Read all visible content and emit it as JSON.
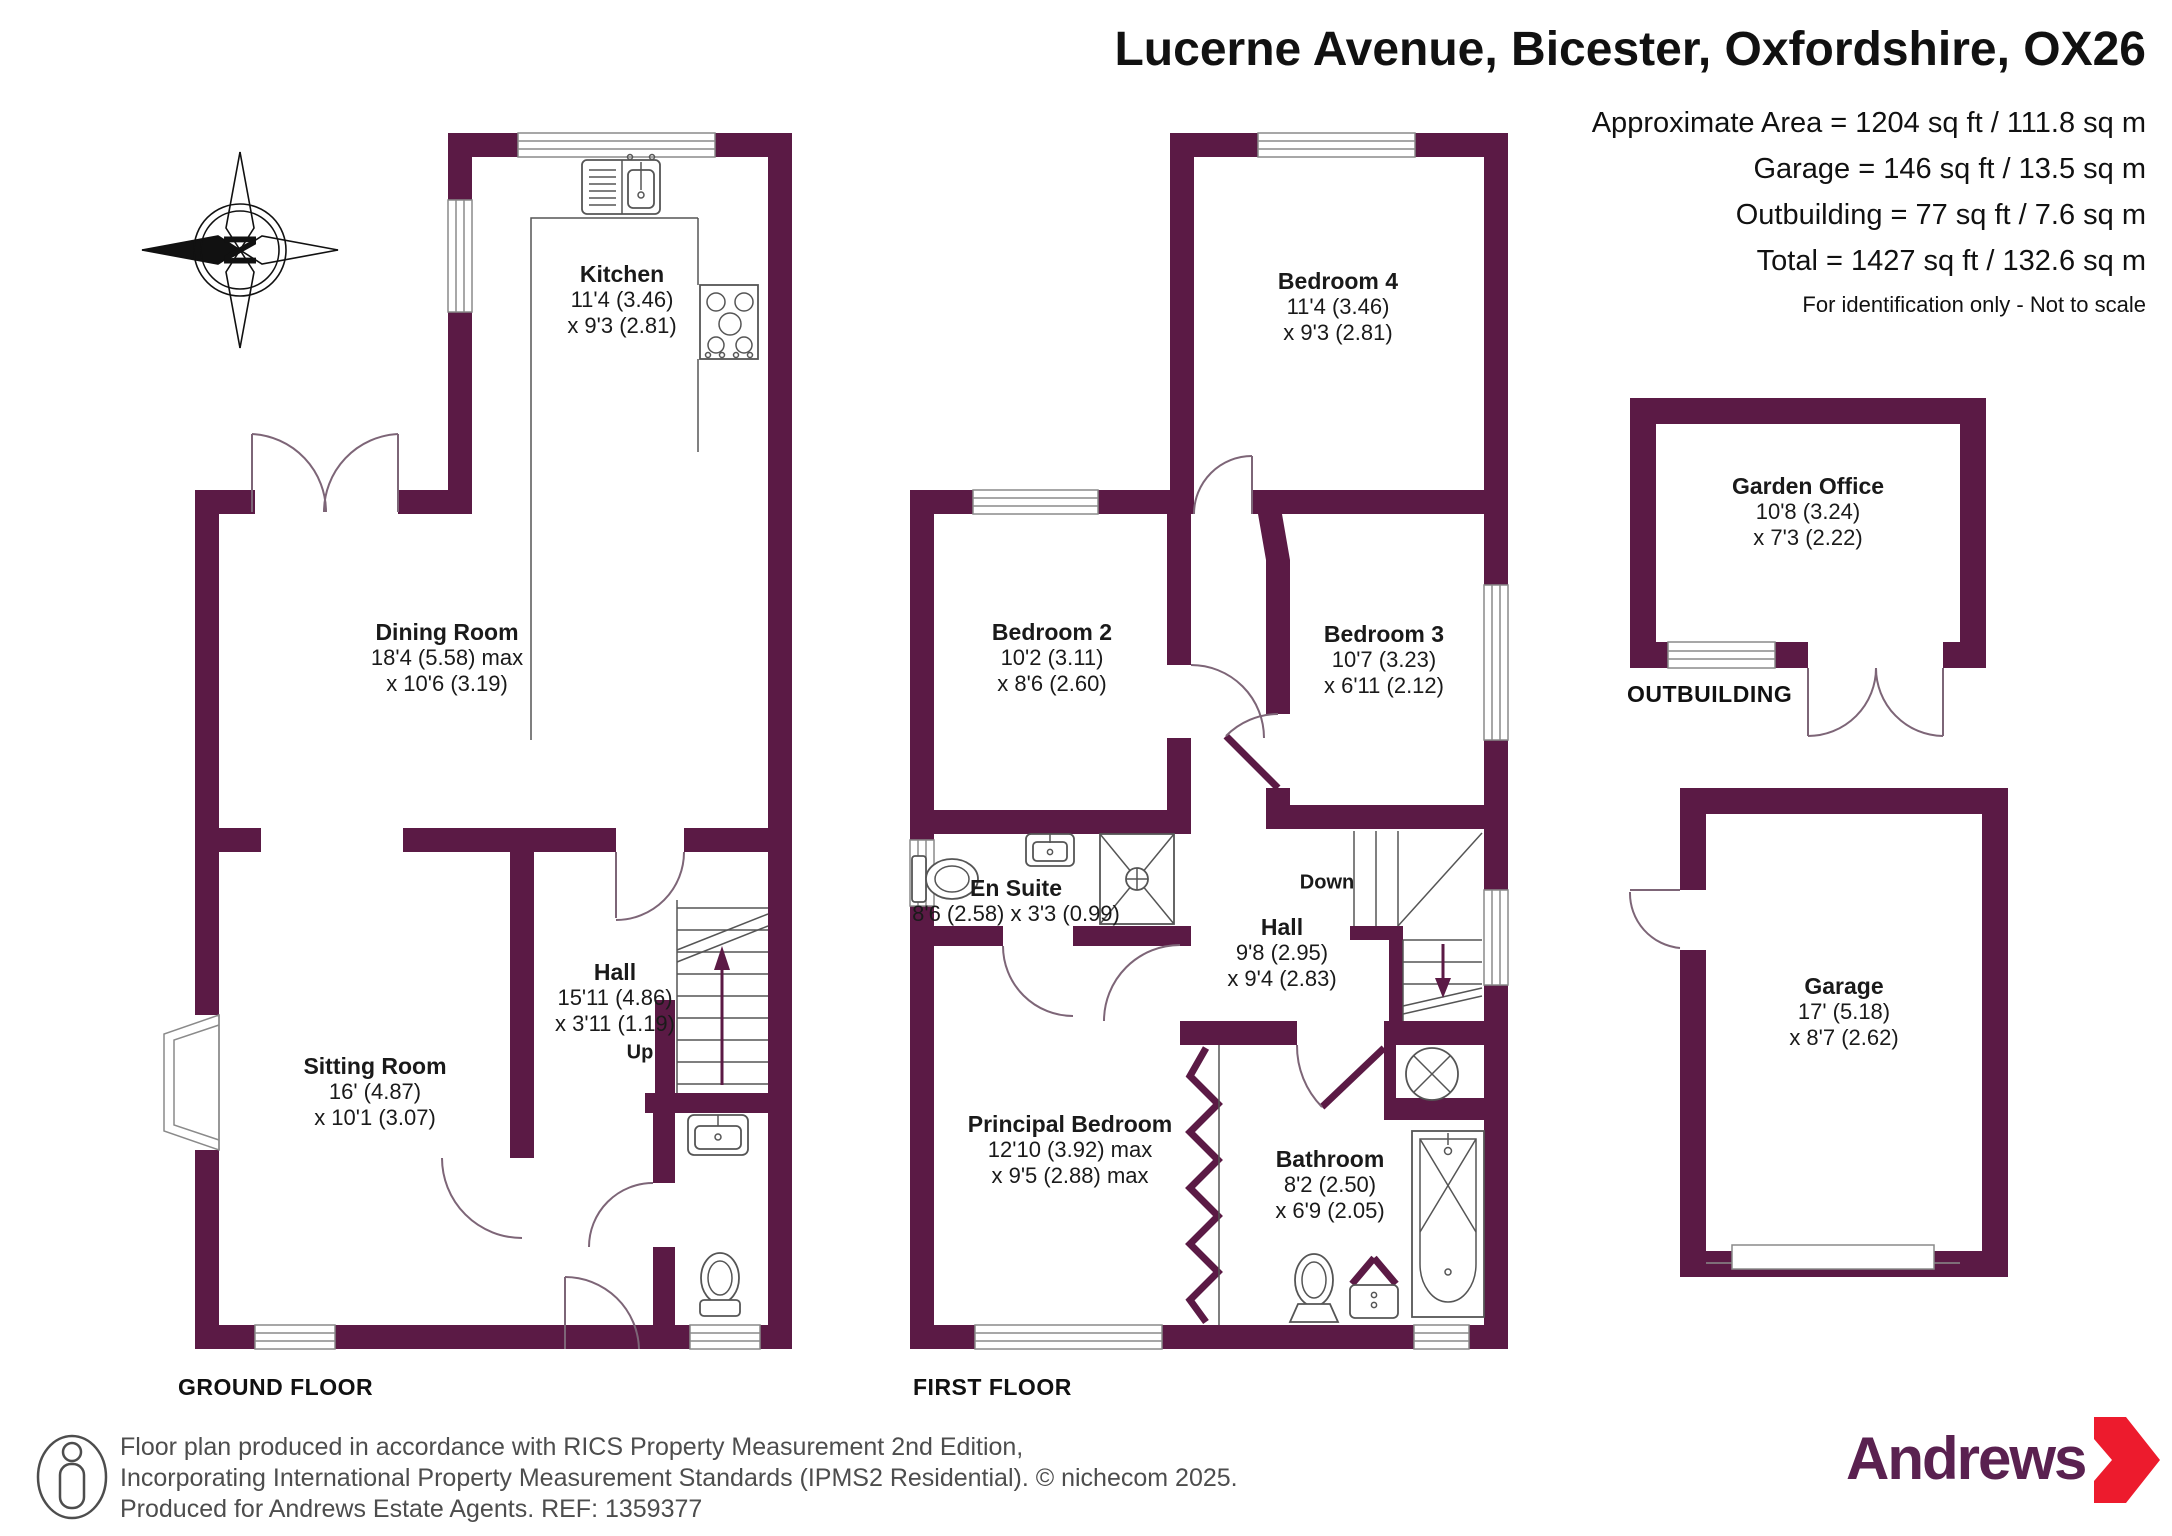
{
  "header": {
    "title": "Lucerne Avenue, Bicester, Oxfordshire, OX26",
    "area_lines": [
      "Approximate Area = 1204 sq ft / 111.8 sq m",
      "Garage = 146 sq ft / 13.5 sq m",
      "Outbuilding = 77 sq ft / 7.6 sq m",
      "Total = 1427 sq ft / 132.6 sq m"
    ],
    "note": "For identification only - Not to scale"
  },
  "compass": {
    "north_label": "N"
  },
  "floors": {
    "ground": {
      "label": "GROUND FLOOR",
      "up_label": "Up",
      "rooms": {
        "kitchen": {
          "name": "Kitchen",
          "dims": [
            "11'4 (3.46)",
            "x 9'3 (2.81)"
          ]
        },
        "dining_room": {
          "name": "Dining Room",
          "dims": [
            "18'4 (5.58) max",
            "x 10'6 (3.19)"
          ]
        },
        "sitting_room": {
          "name": "Sitting Room",
          "dims": [
            "16' (4.87)",
            "x 10'1 (3.07)"
          ]
        },
        "hall": {
          "name": "Hall",
          "dims": [
            "15'11 (4.86)",
            "x 3'11 (1.19)"
          ]
        }
      }
    },
    "first": {
      "label": "FIRST FLOOR",
      "down_label": "Down",
      "rooms": {
        "bedroom4": {
          "name": "Bedroom 4",
          "dims": [
            "11'4 (3.46)",
            "x 9'3 (2.81)"
          ]
        },
        "bedroom2": {
          "name": "Bedroom 2",
          "dims": [
            "10'2 (3.11)",
            "x 8'6 (2.60)"
          ]
        },
        "bedroom3": {
          "name": "Bedroom 3",
          "dims": [
            "10'7 (3.23)",
            "x 6'11 (2.12)"
          ]
        },
        "en_suite": {
          "name": "En Suite",
          "dims": [
            "8'6 (2.58) x 3'3 (0.99)"
          ]
        },
        "hall": {
          "name": "Hall",
          "dims": [
            "9'8 (2.95)",
            "x 9'4 (2.83)"
          ]
        },
        "principal_bedroom": {
          "name": "Principal Bedroom",
          "dims": [
            "12'10 (3.92) max",
            "x 9'5 (2.88) max"
          ]
        },
        "bathroom": {
          "name": "Bathroom",
          "dims": [
            "8'2 (2.50)",
            "x 6'9 (2.05)"
          ]
        }
      }
    },
    "outbuilding": {
      "label": "OUTBUILDING",
      "rooms": {
        "garden_office": {
          "name": "Garden Office",
          "dims": [
            "10'8 (3.24)",
            "x 7'3 (2.22)"
          ]
        }
      }
    },
    "garage": {
      "rooms": {
        "garage": {
          "name": "Garage",
          "dims": [
            "17' (5.18)",
            "x 8'7 (2.62)"
          ]
        }
      }
    }
  },
  "footer": {
    "lines": [
      "Floor plan produced in accordance with RICS Property Measurement 2nd Edition,",
      "Incorporating International Property Measurement Standards (IPMS2 Residential).   © nichecom 2025.",
      "Produced for Andrews Estate Agents.   REF: 1359377"
    ],
    "brand": "Andrews"
  },
  "colors": {
    "wall": "#5B1A45",
    "brand_plum": "#5A2150",
    "brand_red": "#ED1B2D"
  }
}
